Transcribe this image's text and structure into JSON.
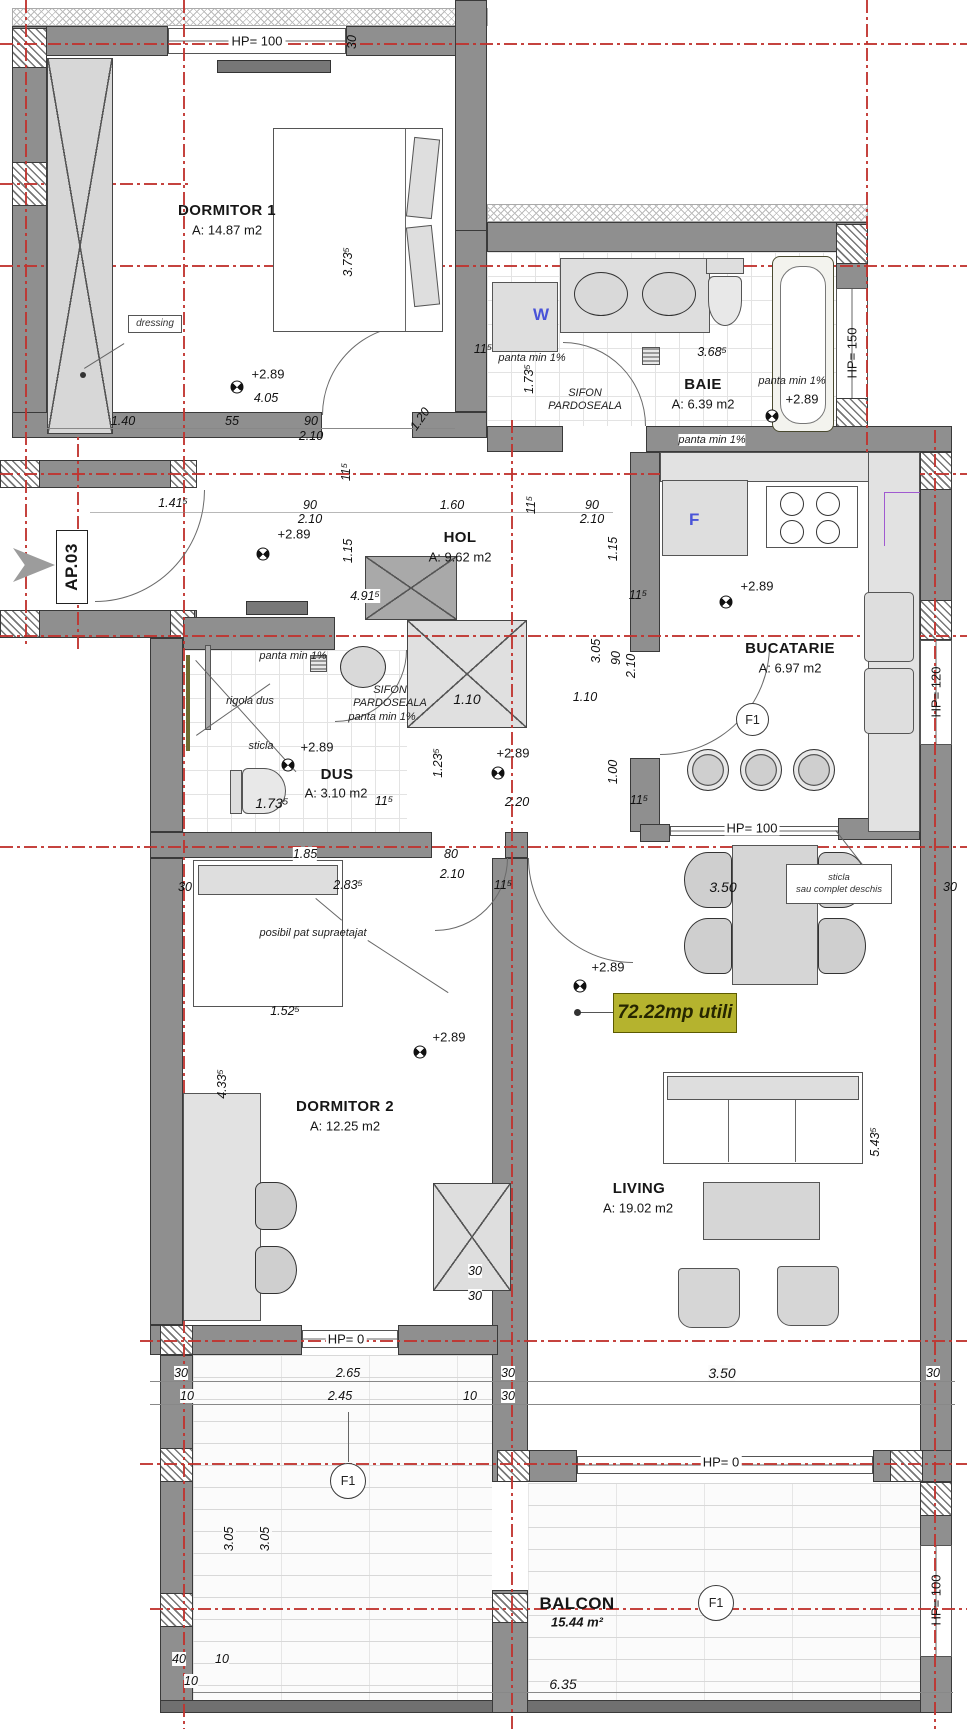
{
  "ap": {
    "label": "AP.03"
  },
  "badge": {
    "text": "72.22mp utili"
  },
  "rooms": {
    "dormitor1": {
      "name": "DORMITOR 1",
      "area": "A: 14.87 m2"
    },
    "baie": {
      "name": "BAIE",
      "area": "A: 6.39 m2"
    },
    "hol": {
      "name": "HOL",
      "area": "A: 9.62 m2"
    },
    "bucatarie": {
      "name": "BUCATARIE",
      "area": "A: 6.97 m2"
    },
    "dus": {
      "name": "DUS",
      "area": "A: 3.10 m2"
    },
    "dormitor2": {
      "name": "DORMITOR 2",
      "area": "A: 12.25 m2"
    },
    "living": {
      "name": "LIVING",
      "area": "A: 19.02 m2"
    },
    "balcon": {
      "name": "BALCON",
      "area": "15.44 m²"
    }
  },
  "hp": {
    "top": "HP= 100",
    "baie_right": "HP= 150",
    "kitchen_window": "HP= 120",
    "kitchen_bar": "HP= 100",
    "dorm2_door": "HP= 0",
    "living_door": "HP= 0",
    "balcony_right": "HP= 100"
  },
  "ann": {
    "dressing": "dressing",
    "panta": "panta min 1%",
    "sifon1": "SIFON",
    "sifon2": "PARDOSEALA",
    "rigola": "rigola dus",
    "sticla": "sticla",
    "sticla_box1": "sticla",
    "sticla_box2": "sau complet deschis",
    "posibil": "posibil pat supraetajat",
    "level": "+2.89",
    "w": "W",
    "f": "F",
    "f1": "F1"
  },
  "dims": [
    "1.40",
    "55",
    "90",
    "2.10",
    "1.20",
    "3.73⁵",
    "30",
    "4.05",
    "11⁵",
    "1.73⁵",
    "3.68⁵",
    "1.41⁵",
    "90",
    "2.10",
    "11⁵",
    "1.60",
    "11⁵",
    "90",
    "2.10",
    "1.15",
    "1.15",
    "4.91⁵",
    "3.05",
    "90",
    "2.10",
    "11⁵",
    "11⁵",
    "1.00",
    "1.10",
    "1.10",
    "1.23⁵",
    "2.20",
    "1.73⁵",
    "11⁵",
    "1.85",
    "80",
    "2.10",
    "2.83⁵",
    "11⁵",
    "30",
    "1.52⁵",
    "4.33⁵",
    "5.43⁵",
    "3.50",
    "30",
    "30",
    "30",
    "3.50",
    "30",
    "30",
    "2.65",
    "30",
    "10",
    "2.45",
    "10",
    "30",
    "3.05",
    "3.05",
    "40",
    "10",
    "10",
    "6.35"
  ]
}
